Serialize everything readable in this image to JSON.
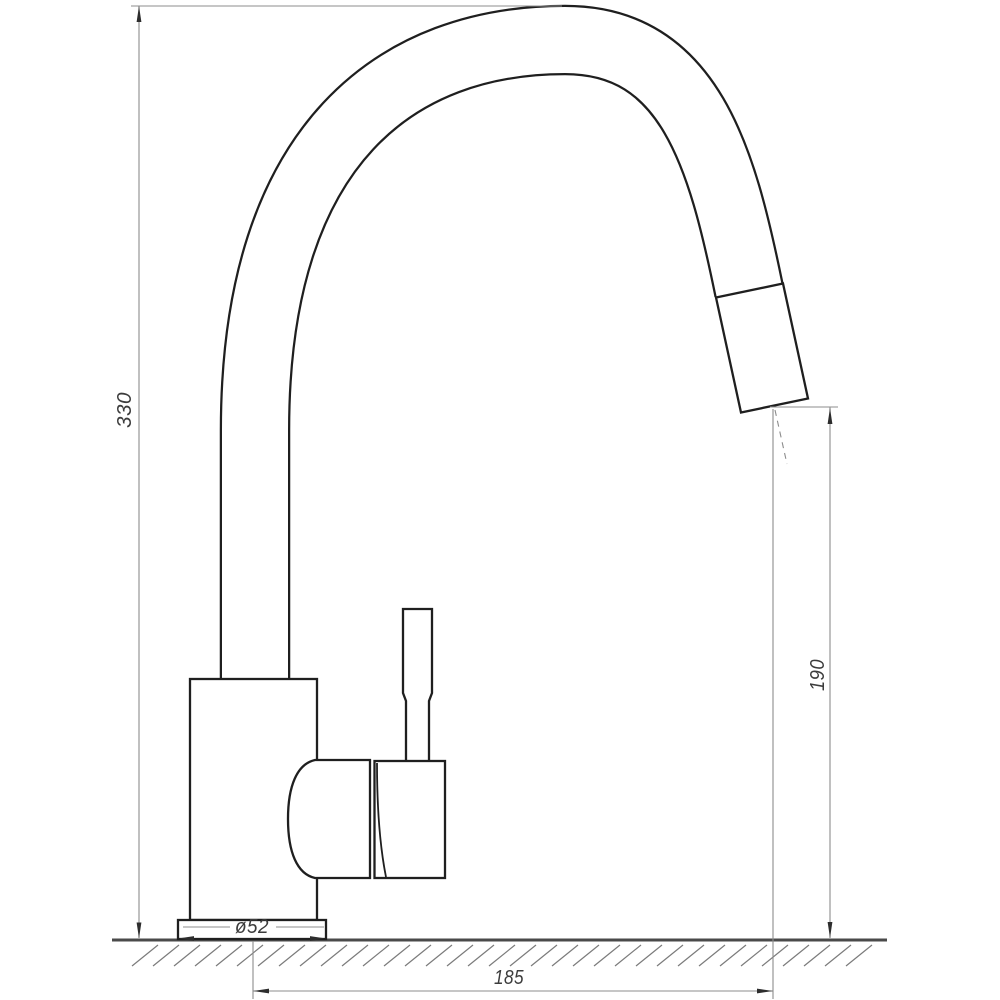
{
  "drawing": {
    "subject": "Kitchen mixer tap with pull-out spray head — dimensioned side elevation",
    "dimensions": {
      "overall_height": "330",
      "outlet_height": "190",
      "base_diameter": "ø52",
      "spout_reach": "185"
    },
    "colors": {
      "background": "#ffffff",
      "outline": "#1f1f1f",
      "dimension": "#8c8c8c",
      "arrow": "#2d2d2d",
      "text": "#3c3c3c",
      "ground": "#4a4a4a",
      "hatch": "#7b7b7b"
    }
  }
}
